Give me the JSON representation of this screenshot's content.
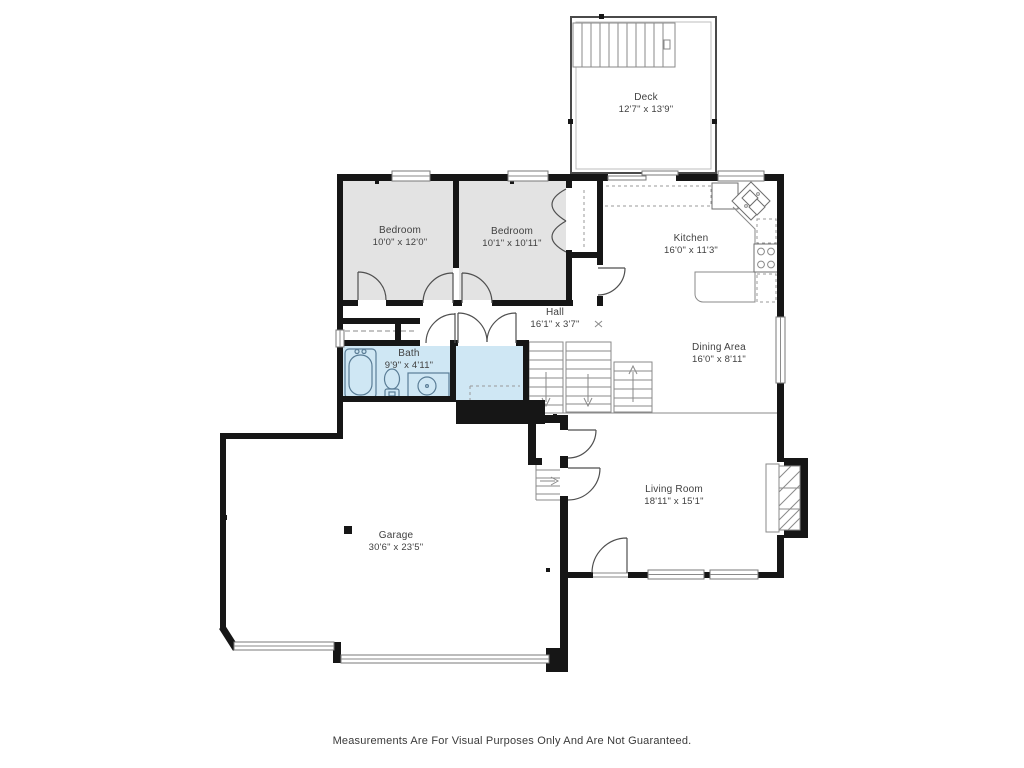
{
  "floorplan": {
    "rooms": {
      "deck": {
        "name": "Deck",
        "dims": "12'7\" x 13'9\""
      },
      "bedroom1": {
        "name": "Bedroom",
        "dims": "10'0\" x 12'0\""
      },
      "bedroom2": {
        "name": "Bedroom",
        "dims": "10'1\" x 10'11\""
      },
      "kitchen": {
        "name": "Kitchen",
        "dims": "16'0\" x 11'3\""
      },
      "hall": {
        "name": "Hall",
        "dims": "16'1\" x 3'7\""
      },
      "bath": {
        "name": "Bath",
        "dims": "9'9\" x 4'11\""
      },
      "dining": {
        "name": "Dining Area",
        "dims": "16'0\" x 8'11\""
      },
      "living": {
        "name": "Living Room",
        "dims": "18'11\" x 15'1\""
      },
      "garage": {
        "name": "Garage",
        "dims": "30'6\" x 23'5\""
      }
    },
    "footer": {
      "disclaimer": "Measurements Are For Visual Purposes Only And Are Not Guaranteed."
    },
    "colors": {
      "wall": "#161616",
      "bedroom_fill": "#e3e3e3",
      "bath_fill": "#cfe7f4",
      "thin_line": "#8a8a8a",
      "text": "#3f3f3f"
    }
  }
}
